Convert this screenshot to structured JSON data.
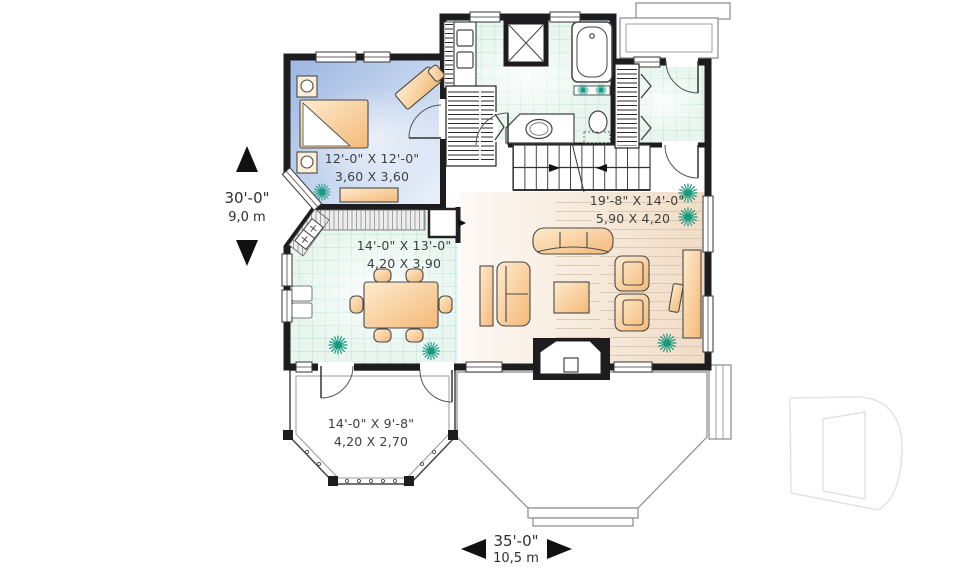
{
  "plan": {
    "rooms": {
      "bedroom": {
        "dims_ft": "12'-0\" X 12'-0\"",
        "dims_m": "3,60 X 3,60"
      },
      "dining": {
        "dims_ft": "14'-0\" X 13'-0\"",
        "dims_m": "4,20 X 3,90"
      },
      "living": {
        "dims_ft": "19'-8\" X 14'-0\"",
        "dims_m": "5,90 X 4,20"
      },
      "veranda": {
        "dims_ft": "14'-0\" X 9'-8\"",
        "dims_m": "4,20 X 2,70"
      }
    },
    "overall_dims": {
      "depth_ft": "30'-0\"",
      "depth_m": "9,0 m",
      "width_ft": "35'-0\"",
      "width_m": "10,5 m"
    },
    "icons": {
      "logo": "drummond-d-monogram",
      "plant": "plant-starburst",
      "dimension_arrows": [
        "up",
        "down",
        "left",
        "right"
      ]
    },
    "colors": {
      "wall": "#1d1d1f",
      "bedroom_floor": "#9db7e2",
      "tile_floor": "#e9f6f0",
      "tile_line": "#b7e0d4",
      "wood_floor": "#f0dcc5",
      "furniture": "#f5b877",
      "plant": "#17987f",
      "text": "#3f3f3f"
    }
  }
}
